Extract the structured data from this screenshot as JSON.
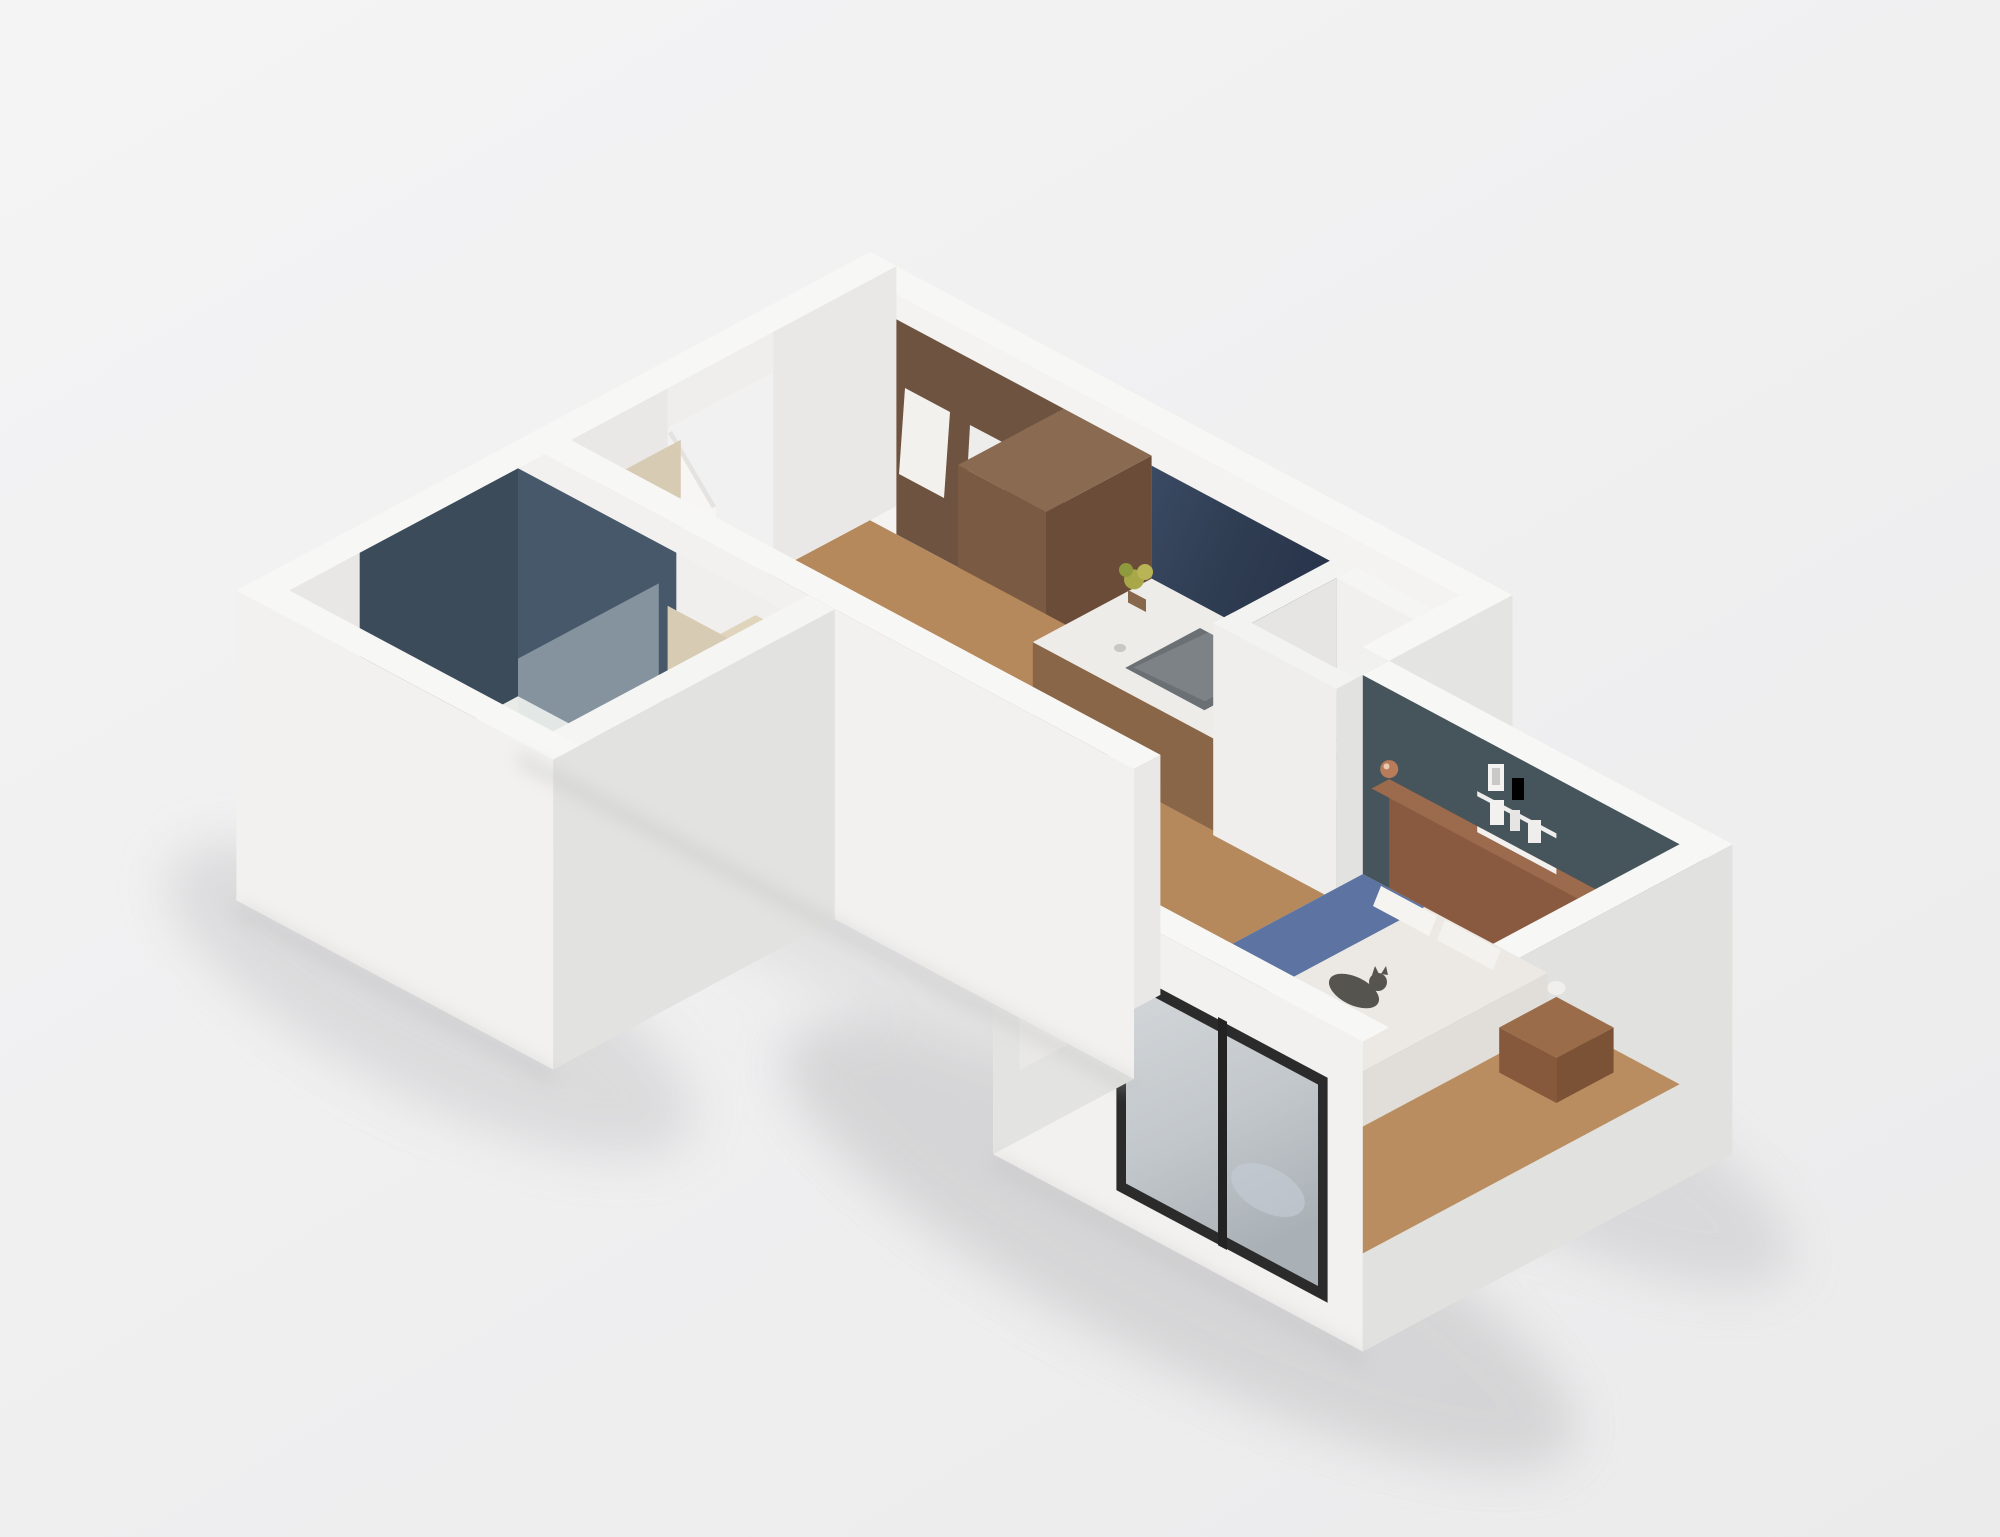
{
  "scene": {
    "type": "isometric-3d-apartment-floor-plan",
    "rooms": [
      "bathroom",
      "hallway",
      "kitchen",
      "ac-shaft",
      "bedroom"
    ]
  },
  "labels": {
    "ac": "AC"
  },
  "colors": {
    "background": "#f0f0f1",
    "wall_top": "#f7f7f5",
    "wall_front": "#f2f1ef",
    "wall_side": "#e1e1df",
    "wall_inner_light": "#f4f3f1",
    "wall_inner_shade": "#e9e8e6",
    "floor_wood": "#b5895c",
    "floor_wood_line": "#9d774c",
    "floor_bath": "#d8dad5",
    "tile_light": "#47586a",
    "tile_dark": "#3b4b5a",
    "accent_wall": "#46555c",
    "headboard_wood": "#8a5a40",
    "wardrobe_wood": "#6e5340",
    "cabinet_wood": "#7a5a42",
    "counter_front": "#8a6648",
    "counter_top": "#eeece8",
    "backsplash_navy": "#2f3d52",
    "sink_gray": "#6b7075",
    "blanket_blue": "#5d74a2",
    "duvet_white": "#ece9e4",
    "window_frame": "#2b2b2b",
    "glass_high": "#d3d7da",
    "glass_low": "#aab1b6",
    "shadow": "#cdcdcf",
    "cat_gray": "#55544f",
    "plant_green": "#a8a848",
    "tan_panel": "#d8cbb4",
    "door_white": "#f7f6f4",
    "ac_text": "#8f8f8d",
    "sconce_copper": "#b87c5a"
  }
}
